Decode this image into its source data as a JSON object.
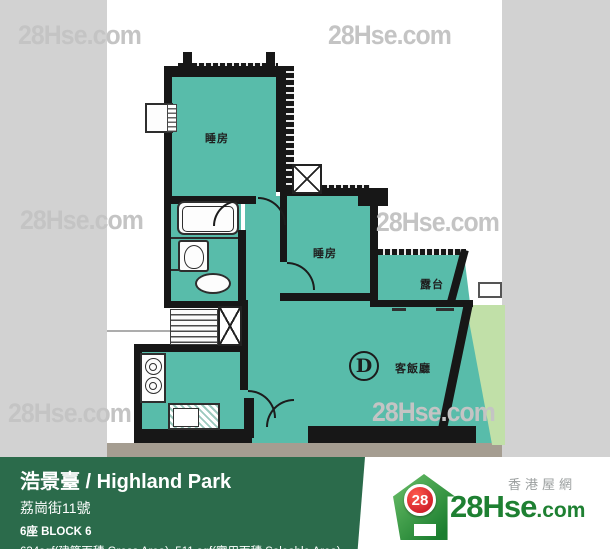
{
  "watermark": {
    "text": "28Hse.com",
    "color": "#c4c4c4"
  },
  "floor_plan": {
    "rooms": [
      {
        "id": "bedroom-1",
        "label": "睡房"
      },
      {
        "id": "bedroom-2",
        "label": "睡房"
      },
      {
        "id": "balcony",
        "label": "露台"
      },
      {
        "id": "living-dining",
        "label": "客飯廳"
      }
    ],
    "unit_letter": "D",
    "colors": {
      "room_fill": "#58bcaa",
      "wall": "#171717",
      "outside_green": "#c1e0a8",
      "background_gray": "#d2d2d2",
      "shadow_band": "#a59d91"
    }
  },
  "info_bar": {
    "bg_color": "#2b6b4b",
    "title": "浩景臺 / Highland Park",
    "address": "荔崗街11號",
    "block": "6座   BLOCK 6",
    "area": "634sqf(建築面積 Gross Area), 511 sqf(實用面積 Saleable Area)"
  },
  "logo": {
    "tagline": "香港屋網",
    "badge_number": "28",
    "name_main": "28Hse",
    "name_suffix": ".com",
    "brand_green": "#1e8032",
    "badge_red": "#c00d1e"
  }
}
